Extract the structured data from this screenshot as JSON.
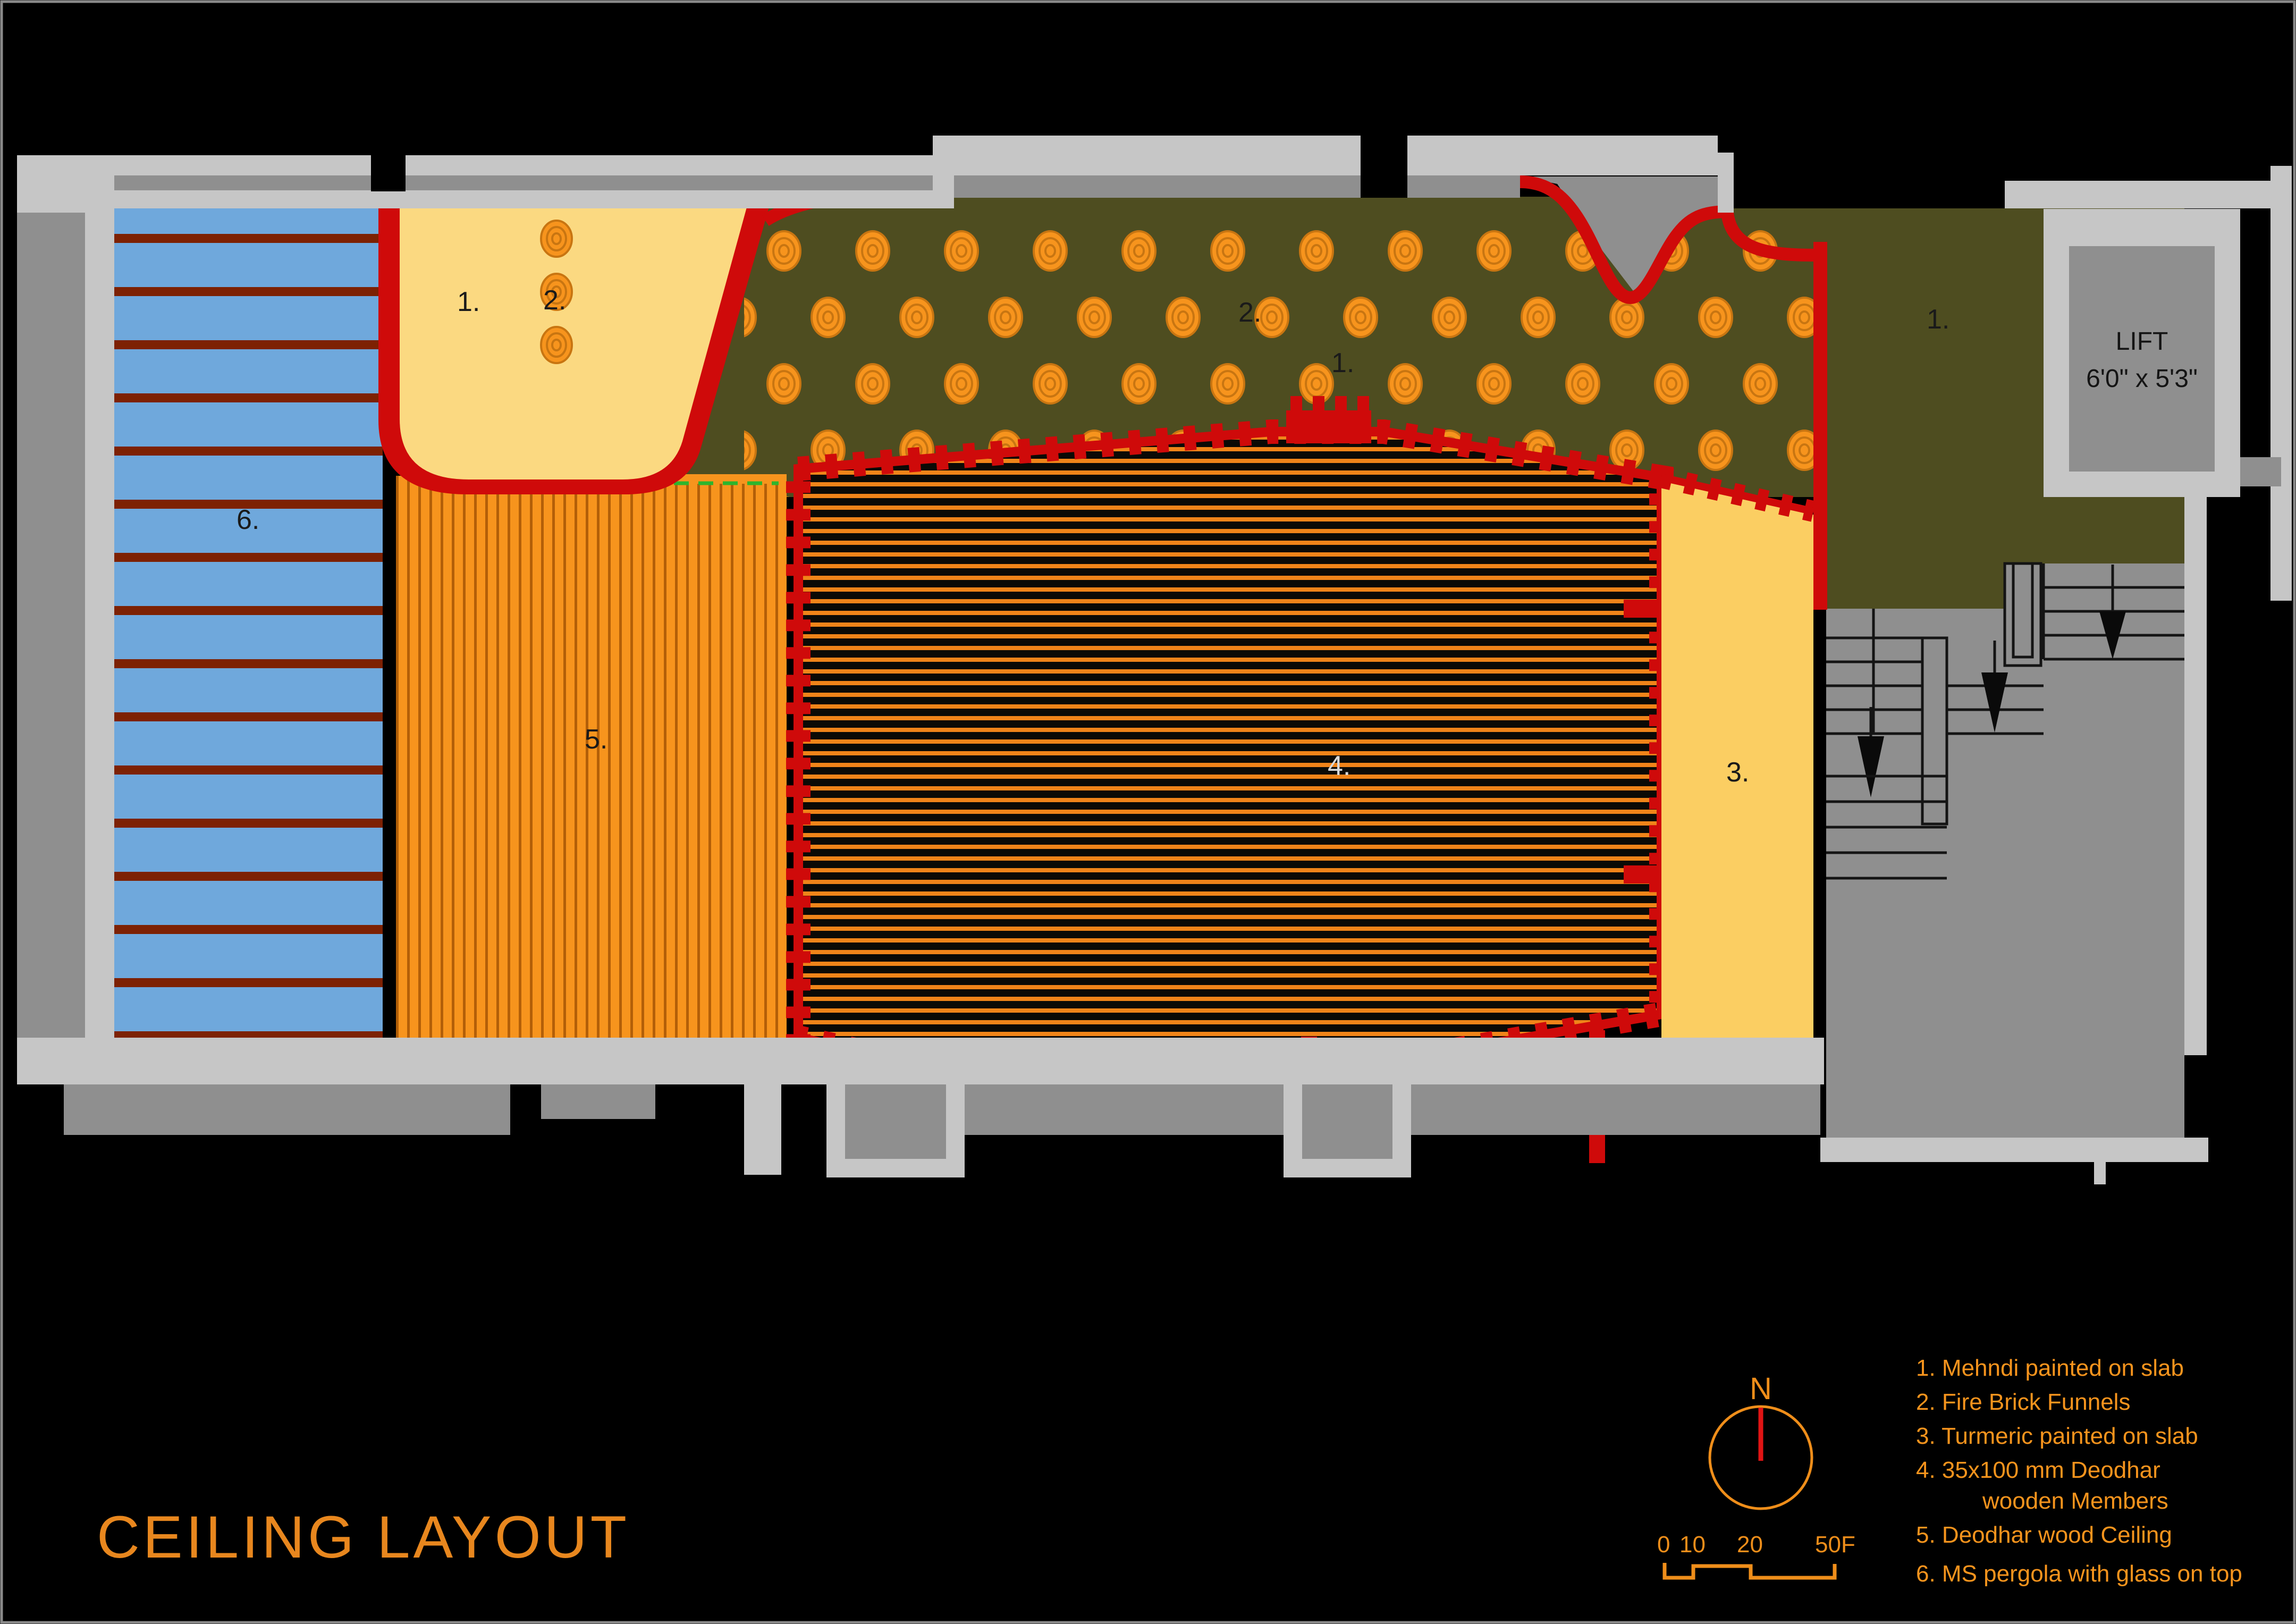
{
  "title": "CEILING LAYOUT",
  "colors": {
    "background": "#000000",
    "wall_light": "#c6c6c6",
    "wall_medium": "#8f8f8f",
    "pergola_blue": "#6fa8dc",
    "pergola_stripe_dark_red": "#7d2103",
    "border_red": "#cf0a0a",
    "orange": "#f7941d",
    "orange_stripe_dark": "#b35f08",
    "mehndi_cream": "#fbd981",
    "turmeric_yellow": "#fbce62",
    "olive_mehndi": "#4e4d20",
    "wood_dark": "#0b0a06",
    "legend_orange": "#f7941d",
    "title_orange": "#e8871e",
    "compass_needle_red": "#e11414",
    "step_line": "#141414"
  },
  "labels": {
    "region_pergola": "6.",
    "region_cream_mehndi": "1.",
    "region_cream_funnels": "2.",
    "region_olive_funnels": "2.",
    "region_olive_mehndi": "1.",
    "region_olive_right": "1.",
    "region_wood_ceiling": "5.",
    "region_wood_members": "4.",
    "region_turmeric": "3."
  },
  "lift": {
    "line1": "LIFT",
    "line2": "6'0\" x 5'3\""
  },
  "compass": {
    "north_label": "N"
  },
  "scale_bar": {
    "t0": "0",
    "t1": "10",
    "t2": "20",
    "t3": "50F"
  },
  "legend": {
    "items": [
      "1. Mehndi painted on slab",
      "2. Fire Brick Funnels",
      "3. Turmeric painted on slab",
      "4. 35x100 mm Deodhar",
      "wooden Members",
      "5. Deodhar wood Ceiling",
      "6. MS pergola with glass on top"
    ]
  }
}
